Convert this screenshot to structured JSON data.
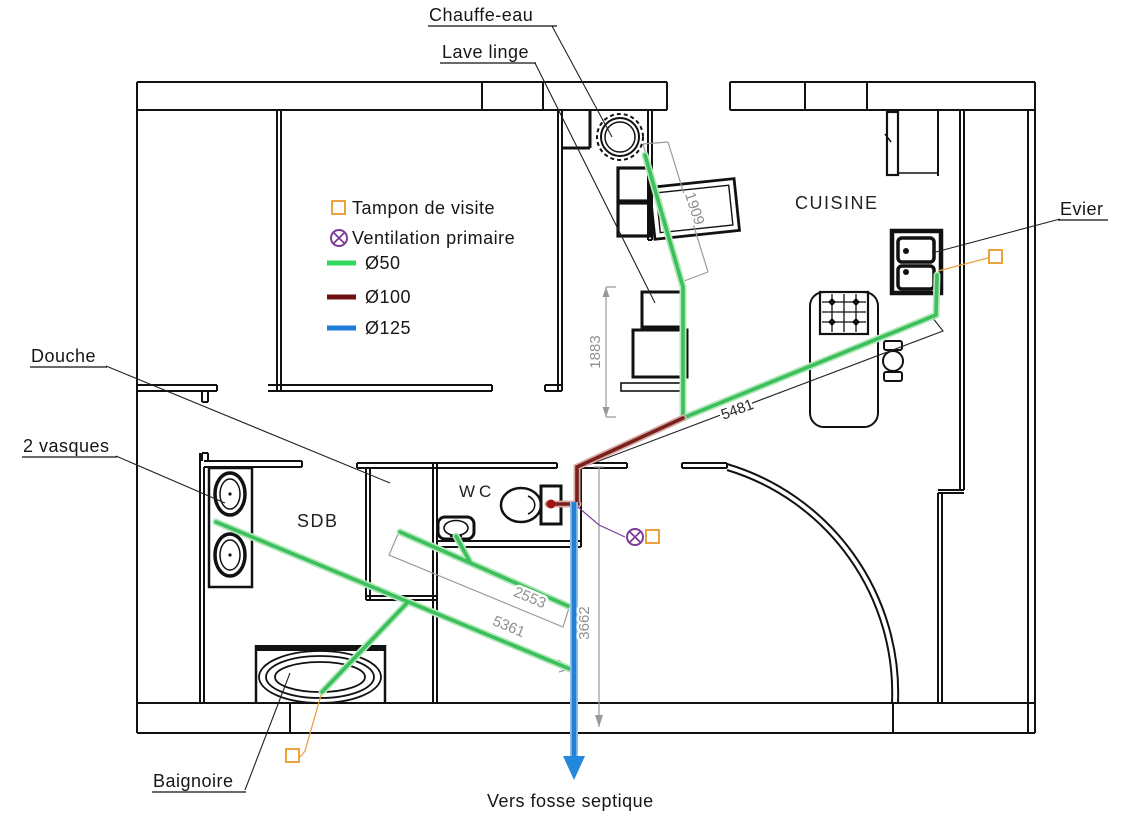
{
  "rooms": {
    "cuisine": "CUISINE",
    "sdb": "SDB",
    "wc": "WC"
  },
  "labels": {
    "chauffe_eau": "Chauffe-eau",
    "lave_linge": "Lave linge",
    "evier": "Evier",
    "douche": "Douche",
    "vasques": "2 vasques",
    "baignoire": "Baignoire",
    "fosse": "Vers fosse septique"
  },
  "legend": {
    "items": [
      {
        "id": "tampon",
        "label": "Tampon de visite",
        "color": "#EBA23E",
        "symbol": "square"
      },
      {
        "id": "ventilation",
        "label": "Ventilation primaire",
        "color": "#8E3FAE",
        "symbol": "circle-x"
      },
      {
        "id": "d50",
        "label": "Ø50",
        "color": "#2FD95C",
        "symbol": "line"
      },
      {
        "id": "d100",
        "label": "Ø100",
        "color": "#6E1012",
        "symbol": "line"
      },
      {
        "id": "d125",
        "label": "Ø125",
        "color": "#1F7CD8",
        "symbol": "line"
      }
    ]
  },
  "pipes": {
    "d50": "#3CC05C",
    "d100": "#7A211D",
    "d125": "#2380D6"
  },
  "dimensions": {
    "lave_linge": "1909",
    "colonne": "1883",
    "evier_run": "5481",
    "douche_run": "2553",
    "sdb_run": "5361",
    "chute": "3662"
  }
}
